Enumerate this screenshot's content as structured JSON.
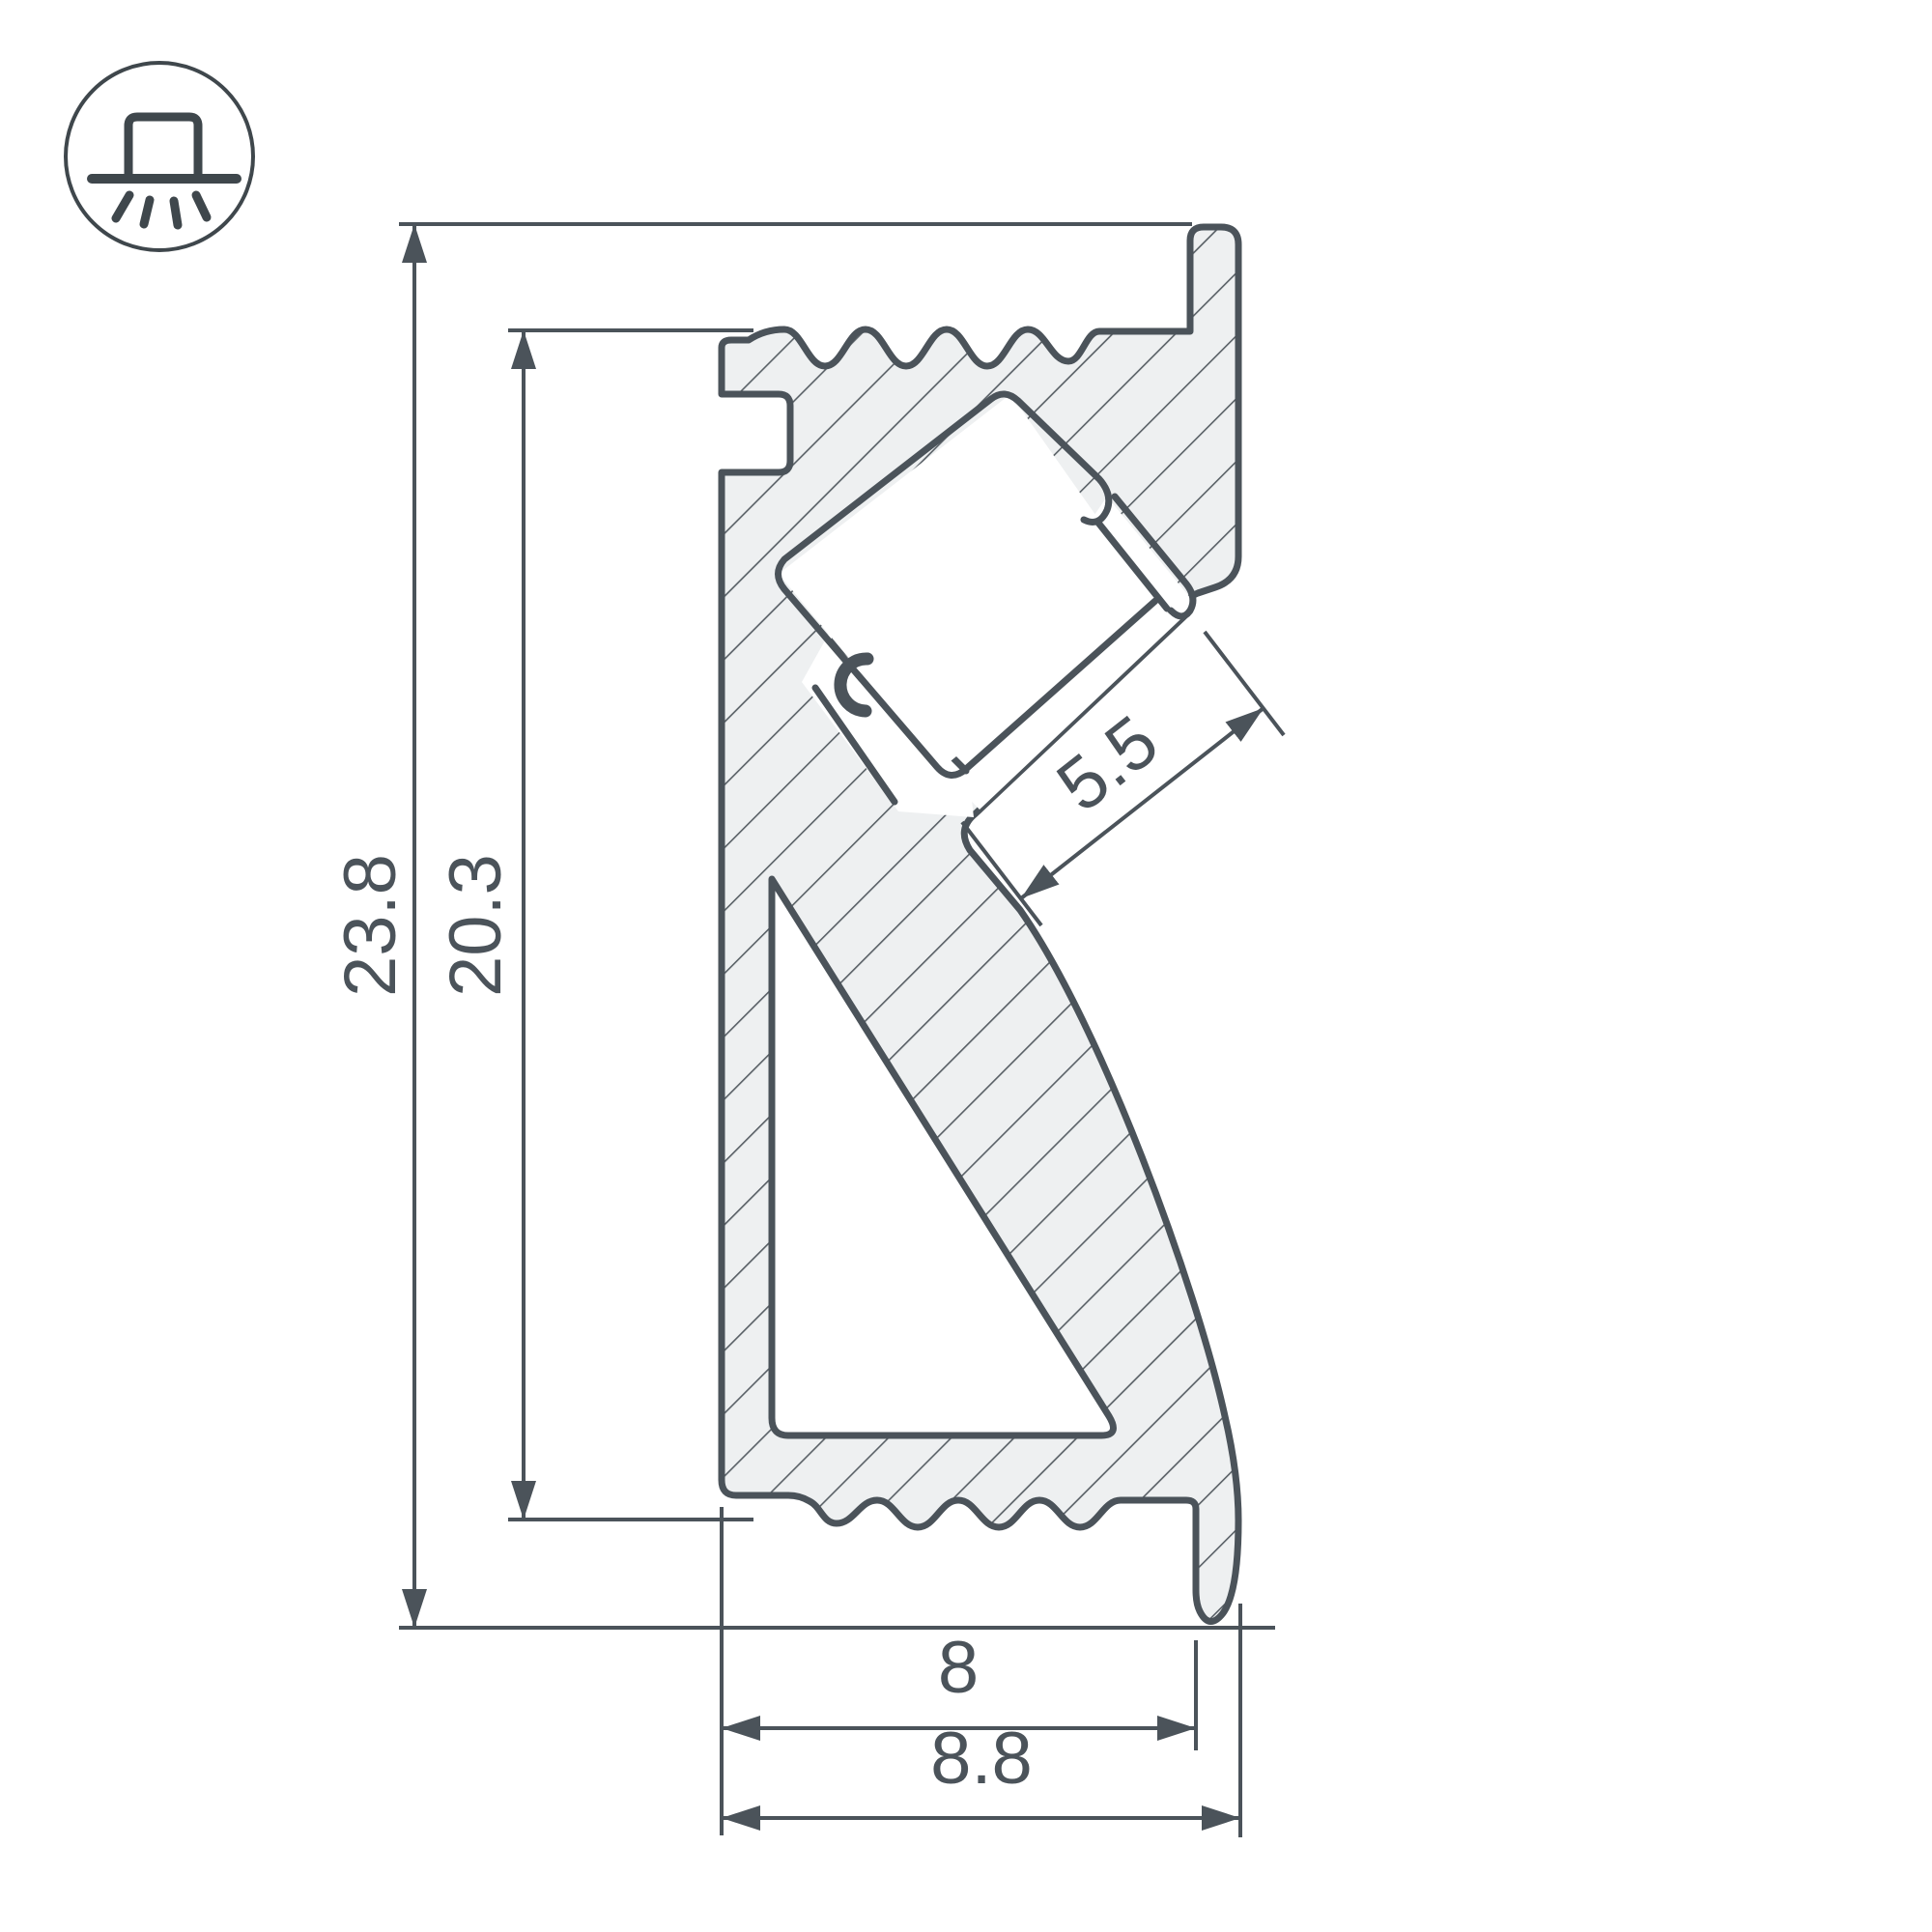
{
  "drawing": {
    "title": "led-profile-cross-section",
    "icon": "surface-mounted-downlight-icon",
    "dims": {
      "overall_height": "23.8",
      "body_height": "20.3",
      "led_channel_width": "5.5",
      "base_width": "8",
      "overall_width": "8.8"
    },
    "colors": {
      "stroke": "#4b535a",
      "body_fill": "#eef0f1",
      "hatch": "#596066",
      "background": "#ffffff"
    }
  }
}
